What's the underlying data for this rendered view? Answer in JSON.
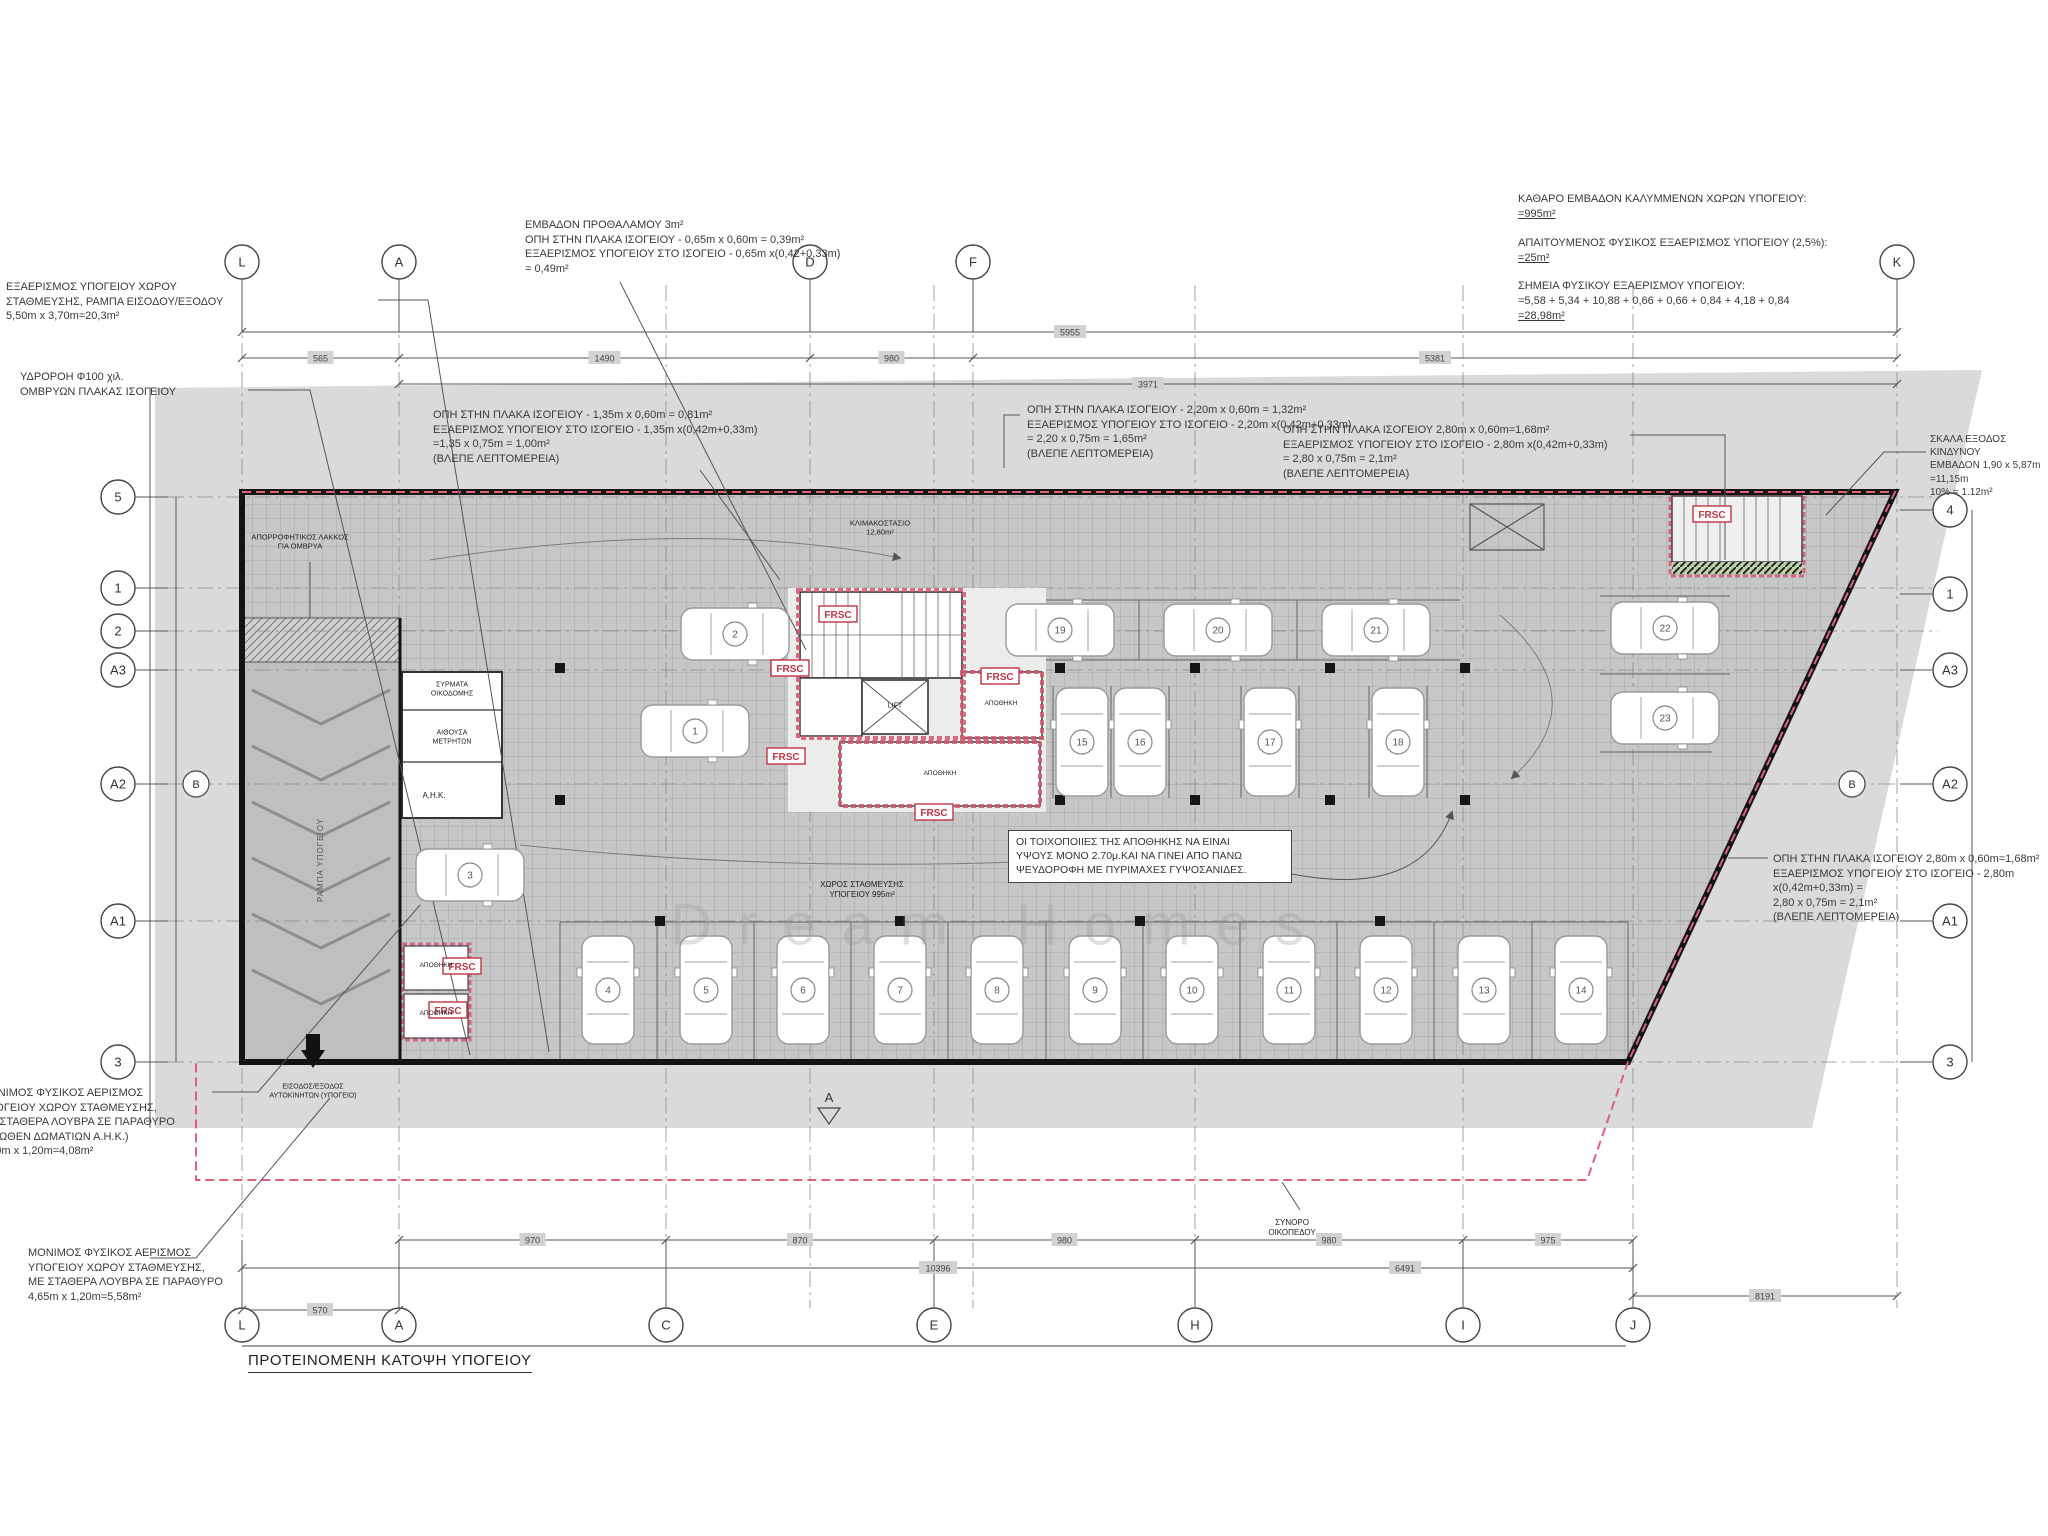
{
  "title": "ΠΡΟΤΕΙΝΟΜΕΝΗ ΚΑΤΟΨΗ ΥΠΟΓΕΙΟΥ",
  "watermark": "Dream Homes",
  "colors": {
    "plot_gray": "#dadada",
    "plan_gray": "#c7c7c7",
    "outline_black": "#141414",
    "accent_red": "#c23445",
    "boundary_pink": "#e0607a"
  },
  "summary": {
    "s1_label": "ΚΑΘΑΡΟ ΕΜΒΑΔΟΝ ΚΑΛΥΜΜΕΝΩΝ ΧΩΡΩΝ ΥΠΟΓΕΙΟΥ:",
    "s1_value": "=995m²",
    "s2_label": "ΑΠΑΙΤΟΥΜΕΝΟΣ ΦΥΣΙΚΟΣ ΕΞΑΕΡΙΣΜΟΣ ΥΠΟΓΕΙΟΥ (2,5%):",
    "s2_value": "=25m²",
    "s3_label": "ΣΗΜΕΙΑ ΦΥΣΙΚΟΥ ΕΞΑΕΡΙΣΜΟΥ ΥΠΟΓΕΙΟΥ:",
    "s3_calc": "=5,58 + 5,34 + 10,88 + 0,66 + 0,66 + 0,84 + 4,18 + 0,84",
    "s3_value": "=28,98m²"
  },
  "annotations": {
    "exaerismos_rampa": "ΕΞΑΕΡΙΣΜΟΣ ΥΠΟΓΕΙΟΥ ΧΩΡΟΥ\nΣΤΑΘΜΕΥΣΗΣ, ΡΑΜΠΑ ΕΙΣΟΔΟΥ/ΕΞΟΔΟΥ\n5,50m x 3,70m=20,3m²",
    "ydroroi": "ΥΔΡΟΡΟΗ Φ100 χιλ.\nΟΜΒΡΥΩΝ ΠΛΑΚΑΣ ΙΣΟΓΕΙΟΥ",
    "prothalamos": "ΕΜΒΑΔΟΝ ΠΡΟΘΑΛΑΜΟΥ 3m²\nΟΠΗ ΣΤΗΝ ΠΛΑΚΑ ΙΣΟΓΕΙΟΥ - 0,65m x 0,60m = 0,39m²\nΕΞΑΕΡΙΣΜΟΣ ΥΠΟΓΕΙΟΥ ΣΤΟ ΙΣΟΓΕΙΟ - 0,65m x(0,42+0,33m)\n= 0,49m²",
    "opi_135": "ΟΠΗ ΣΤΗΝ ΠΛΑΚΑ ΙΣΟΓΕΙΟΥ - 1,35m x 0,60m = 0,81m²\nΕΞΑΕΡΙΣΜΟΣ ΥΠΟΓΕΙΟΥ ΣΤΟ ΙΣΟΓΕΙΟ - 1,35m x(0,42m+0,33m)\n=1,35 x 0,75m = 1,00m²\n(ΒΛΕΠΕ ΛΕΠΤΟΜΕΡΕΙΑ)",
    "opi_220": "ΟΠΗ ΣΤΗΝ ΠΛΑΚΑ ΙΣΟΓΕΙΟΥ - 2,20m x 0,60m = 1,32m²\nΕΞΑΕΡΙΣΜΟΣ ΥΠΟΓΕΙΟΥ ΣΤΟ ΙΣΟΓΕΙΟ - 2,20m x(0,42m+0,33m)\n= 2,20 x 0,75m = 1,65m²\n(ΒΛΕΠΕ ΛΕΠΤΟΜΕΡΕΙΑ)",
    "opi_280_top": "ΟΠΗ ΣΤΗΝ ΠΛΑΚΑ ΙΣΟΓΕΙΟΥ 2,80m x 0,60m=1,68m²\nΕΞΑΕΡΙΣΜΟΣ ΥΠΟΓΕΙΟΥ ΣΤΟ ΙΣΟΓΕΙΟ - 2,80m x(0,42m+0,33m)\n= 2,80 x 0,75m = 2,1m²\n(ΒΛΕΠΕ ΛΕΠΤΟΜΕΡΕΙΑ)",
    "opi_280_right": "ΟΠΗ ΣΤΗΝ ΠΛΑΚΑ ΙΣΟΓΕΙΟΥ 2,80m x 0,60m=1,68m²\nΕΞΑΕΡΙΣΜΟΣ ΥΠΟΓΕΙΟΥ ΣΤΟ ΙΣΟΓΕΙΟ - 2,80m x(0,42m+0,33m) =\n2,80 x 0,75m = 2,1m²\n(ΒΛΕΠΕ ΛΕΠΤΟΜΕΡΕΙΑ)",
    "skala": "ΣΚΑΛΑ ΕΞΟΔΟΣ ΚΙΝΔΥΝΟΥ\nΕΜΒΑΔΟΝ 1,90 x 5,87m =11,15m\n10% = 1.12m²",
    "toixopoiies": "ΟΙ ΤΟΙΧΟΠΟΙΙΕΣ ΤΗΣ ΑΠΟΘΗΚΗΣ ΝΑ ΕΙΝΑΙ\nΥΨΟΥΣ ΜΟΝΟ 2.70μ.ΚΑΙ ΝΑ ΓΙΝΕΙ ΑΠΟ ΠΑΝΩ\nΨΕΥΔΟΡΟΦΗ ΜΕ ΠΥΡΙΜΑΧΕΣ ΓΥΨΟΣΑΝΙΔΕΣ.",
    "monimos1": "ΜΟΝΙΜΟΣ ΦΥΣΙΚΟΣ ΑΕΡΙΣΜΟΣ\nΥΠΟΓΕΙΟΥ ΧΩΡΟΥ ΣΤΑΘΜΕΥΣΗΣ,\nΜΕ ΣΤΑΘΕΡΑ ΛΟΥΒΡΑ ΣΕ ΠΑΡΑΘΥΡΟ\n(ΑΝΩΘΕΝ ΔΩΜΑΤΙΩΝ Α.Η.Κ.)\n3,40m x 1,20m=4,08m²",
    "monimos2": "ΜΟΝΙΜΟΣ ΦΥΣΙΚΟΣ ΑΕΡΙΣΜΟΣ\nΥΠΟΓΕΙΟΥ ΧΩΡΟΥ ΣΤΑΘΜΕΥΣΗΣ,\nΜΕ ΣΤΑΘΕΡΑ ΛΟΥΒΡΑ ΣΕ ΠΑΡΑΘΥΡΟ\n4,65m x 1,20m=5,58m²",
    "synoro": "ΣΥΝΟΡΟ\nΟΙΚΟΠΕΔΟΥ"
  },
  "rooms": {
    "syrmata": "ΣΥΡΜΑΤΑ\nΟΙΚΟΔΟΜΗΣ",
    "aithousa": "ΑΙΘΟΥΣΑ\nΜΕΤΡΗΤΩΝ",
    "ahk": "Α.Η.Κ.",
    "rampa": "ΡΑΜΠΑ ΥΠΟΓΕΙΟΥ",
    "lakkos": "ΑΠΟΡΡΟΦΗΤΙΚΟΣ ΛΑΚΚΟΣ\nΓΙΑ ΟΜΒΡΥΑ",
    "klimakostasio": "ΚΛΙΜΑΚΟΣΤΑΣΙΟ\n12,80m²",
    "lift": "LIFT",
    "apothiki": "ΑΠΟΘΗΚΗ",
    "xoros": "ΧΩΡΟΣ ΣΤΑΘΜΕΥΣΗΣ\nΥΠΟΓΕΙΟΥ 995m²",
    "eisodos": "ΕΙΣΟΔΟΣ/ΕΞΟΔΟΣ\nΑΥΤΟΚΙΝΗΤΩΝ (ΥΠΟΓΕΙΟ)",
    "frsc": "FRSC"
  },
  "grid": {
    "top": [
      "L",
      "A",
      "D",
      "F",
      "K"
    ],
    "bottom": [
      "L",
      "A",
      "C",
      "E",
      "H",
      "I",
      "J"
    ],
    "left": [
      "5",
      "1",
      "2",
      "A3",
      "A2",
      "A1",
      "3"
    ],
    "right": [
      "4",
      "1",
      "A3",
      "A2",
      "A1",
      "3"
    ],
    "section_b": "B",
    "section_a": "A"
  },
  "parking_numbers": [
    "1",
    "2",
    "3",
    "4",
    "5",
    "6",
    "7",
    "8",
    "9",
    "10",
    "11",
    "12",
    "13",
    "14",
    "15",
    "16",
    "17",
    "18",
    "19",
    "20",
    "21",
    "22",
    "23"
  ],
  "dimensions": {
    "top_total": "5955",
    "top_segments": [
      "565",
      "1490",
      "980",
      "5381"
    ],
    "top_secondary": "3971",
    "bottom_segments": [
      "970",
      "870",
      "980",
      "980",
      "975"
    ],
    "bottom_total": "10396",
    "bottom_mid": "6491",
    "bottom_left": "570",
    "bottom_right": "8191"
  }
}
